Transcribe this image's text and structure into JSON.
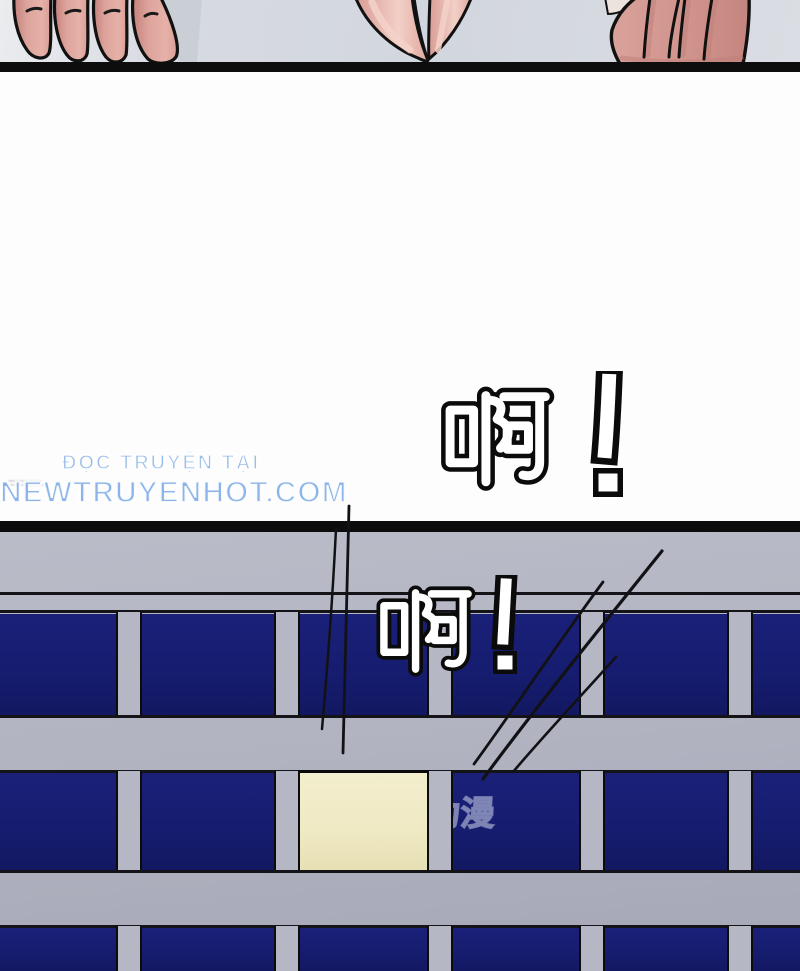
{
  "speech": {
    "shout1": {
      "text": "啊!"
    },
    "shout2": {
      "text": "啊!"
    }
  },
  "watermarks": {
    "site": {
      "line1": "ĐỌC TRUYỆN TẠI",
      "line2": "NEWTRUYENHOT.COM",
      "color": "#7fade6"
    },
    "platform": {
      "text": "腾讯动漫"
    }
  },
  "scene": {
    "top_panel": "fingers gripping a ledge seen from below",
    "bottom_panel": "building facade with window grid, one window lit"
  },
  "colors": {
    "panel_border_black": "#0d0d0e",
    "top_background_gray": "#d7dae1",
    "facade_gray": "#b1b3c1",
    "window_navy": "#161d70",
    "lit_window_cream": "#efe9c4",
    "skin_pink": "#dda49c",
    "shout_fill": "#ffffff",
    "shout_outline": "#0b0b0b"
  }
}
